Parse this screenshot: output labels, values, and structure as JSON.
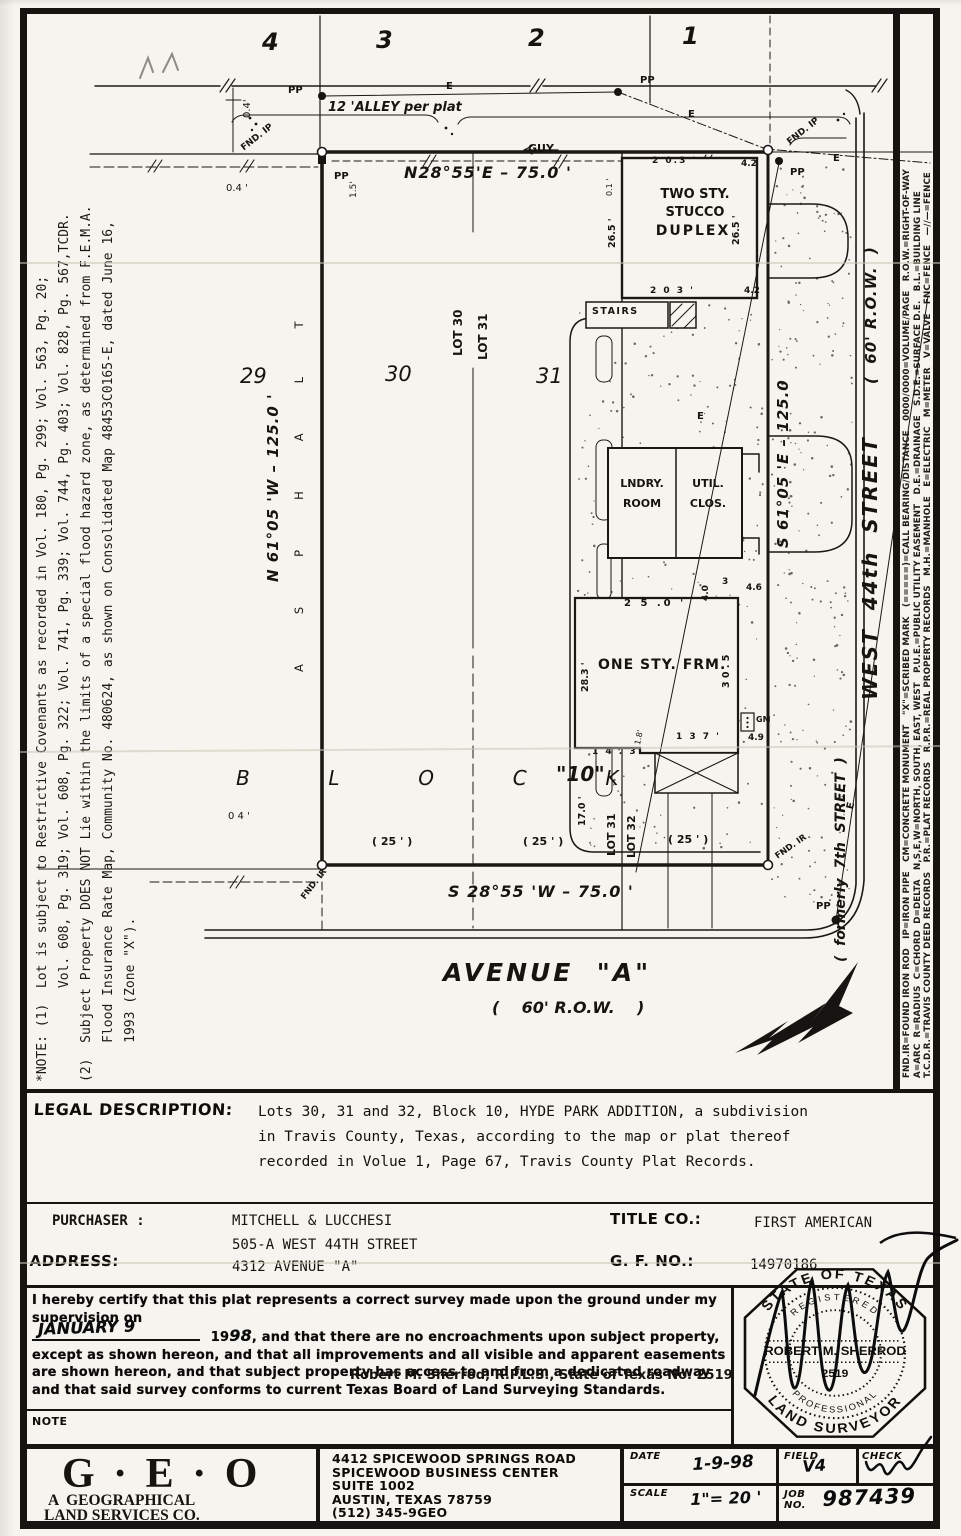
{
  "notes": {
    "lines": [
      "*NOTE: (1)  Lot is subject to Restrictive Covenants as recorded in Vol. 180, Pg. 299; Vol. 563, Pg. 20;",
      "            Vol. 608, Pg. 319; Vol. 608, Pg. 322; Vol. 741, Pg. 339; Vol. 744, Pg. 403; Vol. 828, Pg. 567,TCDR.",
      "(2)  Subject Property DOES NOT Lie within the limits of a special flood hazard zone, as determined from F.E.M.A.",
      "     Flood Insurance Rate Map, Community No. 480624, as shown on Consolidated Map 48453C0165-E, dated June 16,",
      "     1993 (Zone \"X\")."
    ]
  },
  "legend": {
    "lines": [
      "FND.IR=FOUND IRON ROD   IP=IRON PIPE   CM=CONCRETE MONUMENT   \"X\"=SCRIBED MARK   (=====)=CALL BEARING/DISTANCE   0000/0000=VOLUME/PAGE   R.O.W.=RIGHT-OF-WAY",
      "A=ARC  R=RADIUS  C=CHORD  D=DELTA   N,S,E,W=NORTH, SOUTH, EAST, WEST   P.U.E.=PUBLIC UTILITY EASEMENT   D.E.=DRAINAGE   S.D.E.=SURFACE D.E.   B.L.=BUILDING LINE",
      "T.C.D.R.=TRAVIS COUNTY DEED RECORDS   P.R.=PLAT RECORDS   R.P.R.=REAL PROPERTY RECORDS   M.H.=MANHOLE   E=ELECTRIC   M=METER   V=VALVE   FNC=FENCE   —//—=FENCE"
    ]
  },
  "drawing": {
    "labels": [
      {
        "n": "lot-number-4",
        "t": "4",
        "x": 262,
        "y": 30,
        "s": 24,
        "b": 1,
        "i": 1
      },
      {
        "n": "lot-number-3",
        "t": "3",
        "x": 376,
        "y": 28,
        "s": 24,
        "b": 1,
        "i": 1
      },
      {
        "n": "lot-number-2",
        "t": "2",
        "x": 528,
        "y": 26,
        "s": 24,
        "b": 1,
        "i": 1
      },
      {
        "n": "lot-number-1",
        "t": "1",
        "x": 682,
        "y": 24,
        "s": 24,
        "b": 1,
        "i": 1
      },
      {
        "n": "dim-04-top",
        "t": "0.4'",
        "x": 243,
        "y": 118,
        "s": 10,
        "r": -90
      },
      {
        "n": "pp-label",
        "t": "PP",
        "x": 288,
        "y": 86,
        "s": 10,
        "b": 1
      },
      {
        "n": "e-label",
        "t": "E",
        "x": 446,
        "y": 82,
        "s": 10,
        "b": 1
      },
      {
        "n": "pp-label",
        "t": "PP",
        "x": 640,
        "y": 76,
        "s": 10,
        "b": 1
      },
      {
        "n": "alley-label",
        "t": "12 'ALLEY per plat",
        "x": 328,
        "y": 101,
        "s": 13,
        "b": 1,
        "i": 1
      },
      {
        "n": "e-label",
        "t": "E",
        "x": 688,
        "y": 110,
        "s": 10,
        "b": 1
      },
      {
        "n": "fnd-ip-label",
        "t": "FND. IP",
        "x": 240,
        "y": 146,
        "s": 9,
        "r": -38,
        "b": 1
      },
      {
        "n": "fnd-ip-label",
        "t": "FND. IP",
        "x": 786,
        "y": 140,
        "s": 9,
        "r": -38,
        "b": 1
      },
      {
        "n": "guy-label",
        "t": "GUY",
        "x": 528,
        "y": 143,
        "s": 11,
        "b": 1
      },
      {
        "n": "bearing-top",
        "t": "N28°55'E – 75.0 '",
        "x": 404,
        "y": 165,
        "s": 16,
        "b": 1,
        "i": 1,
        "ls": 1
      },
      {
        "n": "pp-label",
        "t": "PP",
        "x": 334,
        "y": 172,
        "s": 10,
        "b": 1
      },
      {
        "n": "dim-15",
        "t": "1.5'",
        "x": 350,
        "y": 198,
        "s": 9,
        "r": -90
      },
      {
        "n": "dim-04-left",
        "t": "0.4 '",
        "x": 226,
        "y": 184,
        "s": 10
      },
      {
        "n": "dim-42",
        "t": "4.2",
        "x": 741,
        "y": 160,
        "s": 9,
        "b": 1
      },
      {
        "n": "dim-203-top",
        "t": "2 0.3 '",
        "x": 652,
        "y": 157,
        "s": 9,
        "b": 1,
        "ls": 2
      },
      {
        "n": "pp-label",
        "t": "PP",
        "x": 790,
        "y": 168,
        "s": 10,
        "b": 1
      },
      {
        "n": "e-label",
        "t": "E",
        "x": 833,
        "y": 154,
        "s": 10,
        "b": 1
      },
      {
        "n": "duplex-label-1",
        "t": "TWO STY.",
        "x": 640,
        "y": 188,
        "s": 13,
        "b": 1,
        "w": 110
      },
      {
        "n": "duplex-label-2",
        "t": "STUCCO",
        "x": 640,
        "y": 206,
        "s": 13,
        "b": 1,
        "w": 110
      },
      {
        "n": "duplex-label-3",
        "t": "DUPLEX",
        "x": 638,
        "y": 224,
        "s": 14,
        "b": 1,
        "w": 110,
        "ls": 2
      },
      {
        "n": "dim-265",
        "t": "26.5 '",
        "x": 608,
        "y": 248,
        "s": 9.5,
        "r": -90,
        "b": 1
      },
      {
        "n": "dim-265",
        "t": "26.5 '",
        "x": 732,
        "y": 245,
        "s": 9.5,
        "r": -90,
        "b": 1
      },
      {
        "n": "dim-01",
        "t": "0.1 '",
        "x": 606,
        "y": 196,
        "s": 8,
        "r": -90
      },
      {
        "n": "dim-203-bot",
        "t": "2 0 3 '",
        "x": 650,
        "y": 287,
        "s": 9,
        "b": 1,
        "ls": 2
      },
      {
        "n": "dim-42",
        "t": "4.2",
        "x": 744,
        "y": 287,
        "s": 9,
        "b": 1
      },
      {
        "n": "stairs-label",
        "t": "STAIRS",
        "x": 592,
        "y": 307,
        "s": 9.5,
        "b": 1,
        "ls": 1.5
      },
      {
        "n": "e-label",
        "t": "E",
        "x": 697,
        "y": 412,
        "s": 10,
        "b": 1
      },
      {
        "n": "lndry-label-1",
        "t": "LNDRY.",
        "x": 610,
        "y": 478,
        "s": 11,
        "b": 1,
        "w": 64
      },
      {
        "n": "lndry-label-2",
        "t": "ROOM",
        "x": 610,
        "y": 498,
        "s": 11,
        "b": 1,
        "w": 64
      },
      {
        "n": "util-label-1",
        "t": "UTIL.",
        "x": 678,
        "y": 478,
        "s": 11,
        "b": 1,
        "w": 60
      },
      {
        "n": "util-label-2",
        "t": "CLOS.",
        "x": 678,
        "y": 498,
        "s": 11,
        "b": 1,
        "w": 60
      },
      {
        "n": "bearing-right",
        "t": "S 61°05 'E – 125.0",
        "x": 776,
        "y": 548,
        "s": 15,
        "b": 1,
        "i": 1,
        "r": -90,
        "ls": 1
      },
      {
        "n": "dim-40",
        "t": "4.0",
        "x": 702,
        "y": 601,
        "s": 9,
        "r": -90,
        "b": 1
      },
      {
        "n": "dim-3",
        "t": "3",
        "x": 722,
        "y": 578,
        "s": 9,
        "b": 1
      },
      {
        "n": "dim-46",
        "t": "4.6",
        "x": 746,
        "y": 584,
        "s": 9,
        "b": 1
      },
      {
        "n": "dim-250",
        "t": "2 5 .0 '",
        "x": 624,
        "y": 599,
        "s": 10,
        "b": 1,
        "ls": 3
      },
      {
        "n": "one-sty-label",
        "t": "ONE STY. FRM.",
        "x": 598,
        "y": 658,
        "s": 14,
        "b": 1,
        "ls": 1
      },
      {
        "n": "dim-283",
        "t": "28.3 '",
        "x": 581,
        "y": 692,
        "s": 9.5,
        "r": -90,
        "b": 1
      },
      {
        "n": "dim-305",
        "t": "3 0 . 5",
        "x": 722,
        "y": 688,
        "s": 9.5,
        "r": -90,
        "b": 1
      },
      {
        "n": "gm-label",
        "t": "GM",
        "x": 756,
        "y": 716,
        "s": 8,
        "b": 1
      },
      {
        "n": "dim-49",
        "t": "4.9",
        "x": 748,
        "y": 734,
        "s": 9,
        "b": 1
      },
      {
        "n": "dim-137",
        "t": "1 3 7 '",
        "x": 676,
        "y": 733,
        "s": 9,
        "b": 1,
        "ls": 2
      },
      {
        "n": "dim-18",
        "t": "1.8'",
        "x": 634,
        "y": 744,
        "s": 8,
        "r": -78
      },
      {
        "n": "dim-143",
        "t": "1 4 . 3",
        "x": 592,
        "y": 748,
        "s": 9,
        "b": 1,
        "ls": 2
      },
      {
        "n": "dim-170",
        "t": "17.0 '",
        "x": 578,
        "y": 826,
        "s": 9.5,
        "r": -90,
        "b": 1
      },
      {
        "n": "lot31-line-label",
        "t": "LOT 31",
        "x": 606,
        "y": 856,
        "s": 11,
        "b": 1,
        "r": -90
      },
      {
        "n": "lot32-line-label",
        "t": "LOT 32",
        "x": 626,
        "y": 858,
        "s": 11,
        "b": 1,
        "r": -90
      },
      {
        "n": "lot-number-29",
        "t": "29",
        "x": 240,
        "y": 366,
        "s": 21,
        "i": 1
      },
      {
        "n": "lot-number-30",
        "t": "30",
        "x": 385,
        "y": 364,
        "s": 21,
        "i": 1
      },
      {
        "n": "lot-number-31",
        "t": "31",
        "x": 536,
        "y": 366,
        "s": 21,
        "i": 1
      },
      {
        "n": "lot30-line-label",
        "t": "LOT 30",
        "x": 452,
        "y": 356,
        "s": 12,
        "b": 1,
        "r": -90
      },
      {
        "n": "lot31-line-label",
        "t": "LOT 31",
        "x": 477,
        "y": 360,
        "s": 12,
        "b": 1,
        "r": -90
      },
      {
        "n": "bearing-left",
        "t": "N 61°05 'W – 125.0 '",
        "x": 266,
        "y": 582,
        "s": 15,
        "b": 1,
        "i": 1,
        "r": -90,
        "ls": 1
      },
      {
        "n": "asphalt-label",
        "t": "ASPHALT",
        "x": 294,
        "y": 672,
        "s": 11.5,
        "r": -90,
        "ls": 50
      },
      {
        "n": "block-label",
        "t": "B  L  O  C  K",
        "x": 236,
        "y": 768,
        "s": 20,
        "i": 1,
        "ls": 22
      },
      {
        "n": "block-number",
        "t": "\"10\"",
        "x": 556,
        "y": 764,
        "s": 20,
        "b": 1,
        "i": 1
      },
      {
        "n": "dim-04-bot",
        "t": "0 4 '",
        "x": 228,
        "y": 812,
        "s": 10
      },
      {
        "n": "lot-width",
        "t": "( 25 ' )",
        "x": 372,
        "y": 836,
        "s": 11,
        "b": 1
      },
      {
        "n": "lot-width",
        "t": "( 25 ' )",
        "x": 523,
        "y": 836,
        "s": 11,
        "b": 1
      },
      {
        "n": "lot-width",
        "t": "( 25 ' )",
        "x": 668,
        "y": 834,
        "s": 11,
        "b": 1
      },
      {
        "n": "fnd-ir-label",
        "t": "FND. IR",
        "x": 300,
        "y": 896,
        "s": 8.5,
        "r": -52,
        "b": 1
      },
      {
        "n": "bearing-bottom",
        "t": "S 28°55 'W – 75.0 '",
        "x": 448,
        "y": 884,
        "s": 16,
        "b": 1,
        "i": 1,
        "ls": 1
      },
      {
        "n": "fnd-ir-label",
        "t": "FND. IR",
        "x": 774,
        "y": 854,
        "s": 8.5,
        "r": -35,
        "b": 1
      },
      {
        "n": "pp-label",
        "t": "PP",
        "x": 816,
        "y": 902,
        "s": 10,
        "b": 1
      },
      {
        "n": "e-label",
        "t": "E",
        "x": 846,
        "y": 808,
        "s": 10,
        "b": 1,
        "r": -76
      },
      {
        "n": "avenue-a-label",
        "t": "AVENUE  \"A\"",
        "x": 443,
        "y": 960,
        "s": 25,
        "b": 1,
        "i": 1,
        "ls": 3
      },
      {
        "n": "avenue-a-row",
        "t": "(    60' R.O.W.    )",
        "x": 492,
        "y": 1000,
        "s": 16,
        "b": 1,
        "i": 1
      },
      {
        "n": "west-44th-street-label",
        "t": "WEST  44th  STREET",
        "x": 860,
        "y": 700,
        "s": 20,
        "b": 1,
        "i": 1,
        "r": -90,
        "ls": 2
      },
      {
        "n": "west-44th-row-label",
        "t": "(  60' R.O.W.  )",
        "x": 864,
        "y": 384,
        "s": 15,
        "b": 1,
        "i": 1,
        "r": -90,
        "ls": 1
      },
      {
        "n": "formerly-7th-label",
        "t": "(  formerly  7th  STREET  )",
        "x": 834,
        "y": 962,
        "s": 14,
        "b": 1,
        "i": 1,
        "r": -90
      }
    ]
  },
  "legal": {
    "label": "LEGAL DESCRIPTION:",
    "lines": [
      "Lots 30, 31 and 32, Block 10, HYDE PARK ADDITION, a subdivision",
      "in Travis County, Texas, according to the map or plat thereof",
      "recorded in Volue 1, Page 67, Travis County Plat Records."
    ]
  },
  "parties": {
    "purchaser_label": "PURCHASER :",
    "purchaser": "MITCHELL & LUCCHESI",
    "address_label": "ADDRESS:",
    "address1": "505-A WEST 44TH STREET",
    "address2": "4312 AVENUE \"A\"",
    "title_label": "TITLE CO.:",
    "title_co": "FIRST AMERICAN",
    "gf_label": "G. F. NO.:",
    "gf_no": "14970186"
  },
  "cert": {
    "intro": "I hereby certify that this plat represents a correct survey made upon the ground under my supervision on",
    "date_hand": "JANUARY 9",
    "year_printed": "19",
    "year_hand": "98",
    "body": ", and that there are no encroachments upon subject property, except as shown hereon, and that all improvements and all visible and apparent easements are shown hereon, and that subject property has access to and from a dedicated roadway and that said survey conforms to current Texas Board of Land Surveying Standards.",
    "signer": "Robert M. Sherrod, R.P.L.S., State of Texas No. 2519"
  },
  "seal": {
    "arc_top": "STATE OF TEXAS",
    "arc_registered": "REGISTERED",
    "name": "ROBERT M. SHERROD",
    "number": "2519",
    "arc_professional": "PROFESSIONAL",
    "arc_bottom": "LAND SURVEYOR"
  },
  "note_row_label": "NOTE",
  "firm": {
    "logo": "G · E · O",
    "sub1": "A  GEOGRAPHICAL",
    "sub2": "LAND SERVICES CO.",
    "addr1": "4412 SPICEWOOD SPRINGS ROAD",
    "addr2": "SPICEWOOD BUSINESS CENTER",
    "addr3": "SUITE 1002",
    "addr4": "AUSTIN, TEXAS 78759",
    "addr5": "(512) 345-9GEO"
  },
  "title_block": {
    "date_label": "DATE",
    "date_value": "1-9-98",
    "field_label": "FIELD",
    "field_value": "V4",
    "check_label": "CHECK",
    "scale_label": "SCALE",
    "scale_value": "1\"= 20 '",
    "job_label": "JOB NO.",
    "job_value": "987439"
  }
}
